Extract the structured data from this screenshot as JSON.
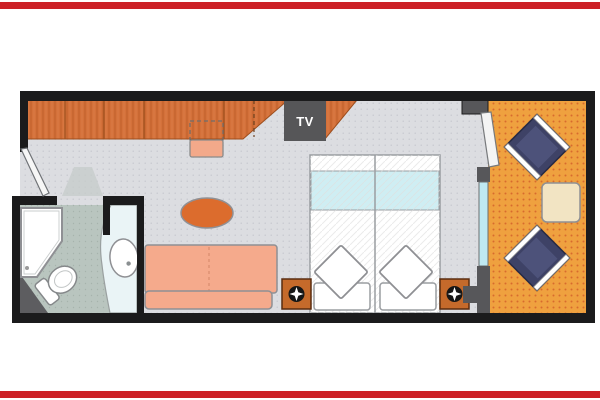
{
  "title": "Cruise stateroom floor plan with private balcony",
  "decorations": {
    "top_bar_color": "#cc2127",
    "bottom_bar_color": "#cc2127"
  },
  "plan": {
    "tv_label": "TV",
    "palette": {
      "wall": "#1b1b1c",
      "wall_gray": "#57575a",
      "cabin_floor": "#dcdde1",
      "bathroom_floor": "#b9c5bf",
      "counter": "#eaf4f6",
      "wardrobe_wood": "#d4713a",
      "tv_box": "#565658",
      "sofa": "#f5aa8c",
      "stool": "#f3a98a",
      "oval_table": "#dc6c2d",
      "bed_linen": "#ffffff",
      "bed_blanket": "#cfeef3",
      "nightstand": "#c56a2b",
      "lamp": "#161616",
      "balcony_floor": "#efa13f",
      "balcony_chair": "#3e4266",
      "balcony_chair_inner": "#4d527a",
      "balcony_table": "#f2e4c3",
      "glass": "#bfe9f2",
      "fixture_white": "#ffffff",
      "dark_wedge": "#5d5d60"
    },
    "rooms": [
      {
        "name": "entry",
        "features": [
          "entry-door"
        ]
      },
      {
        "name": "bathroom",
        "fixtures": [
          "shower",
          "toilet",
          "washbasin",
          "vanity-counter"
        ]
      },
      {
        "name": "cabin",
        "furniture": [
          "wardrobe",
          "tv",
          "stool",
          "coffee-table",
          "sofa",
          "twin-bed",
          "twin-bed",
          "nightstand",
          "nightstand"
        ]
      },
      {
        "name": "balcony",
        "furniture": [
          "deck-chair",
          "deck-chair",
          "side-table"
        ],
        "features": [
          "sliding-glass-door"
        ]
      }
    ],
    "beds": {
      "count": 2,
      "pillows_per_bed": 2
    },
    "balcony_chairs": 2
  }
}
